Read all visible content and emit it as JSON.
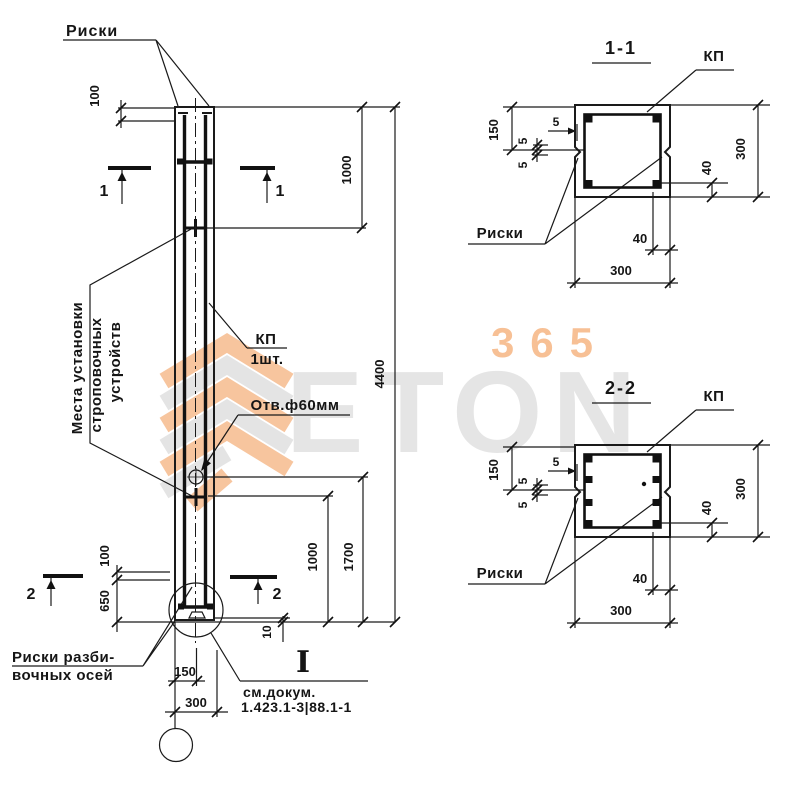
{
  "watermark": {
    "letters": "ETON",
    "number": "365"
  },
  "elevation": {
    "riski_label": "Риски",
    "dim_100_top": "100",
    "dim_1000_top": "1000",
    "dim_4400": "4400",
    "dim_1700": "1700",
    "dim_1000_bottom": "1000",
    "dim_100_bottom": "100",
    "dim_650": "650",
    "dim_10": "10",
    "dim_150": "150",
    "dim_300": "300",
    "sec1": "1",
    "sec2": "2",
    "kp_label": "КП",
    "kp_qty": "1шт.",
    "hole_label": "Отв.ф60мм",
    "strop_line1": "Места установки",
    "strop_line2": "строповочных",
    "strop_line3": "устройств",
    "axes_line1": "Риски разби-",
    "axes_line2": "вочных осей",
    "detail_mark": "I",
    "doc_line1": "см.докум.",
    "doc_line2": "1.423.1-3|88.1-1"
  },
  "sections": [
    {
      "title": "1-1",
      "kp": "КП",
      "riski": "Риски",
      "dim_150": "150",
      "dim_5": "5",
      "dim_40": "40",
      "dim_300": "300"
    },
    {
      "title": "2-2",
      "kp": "КП",
      "riski": "Риски",
      "dim_150": "150",
      "dim_5": "5",
      "dim_40": "40",
      "dim_300": "300"
    }
  ]
}
